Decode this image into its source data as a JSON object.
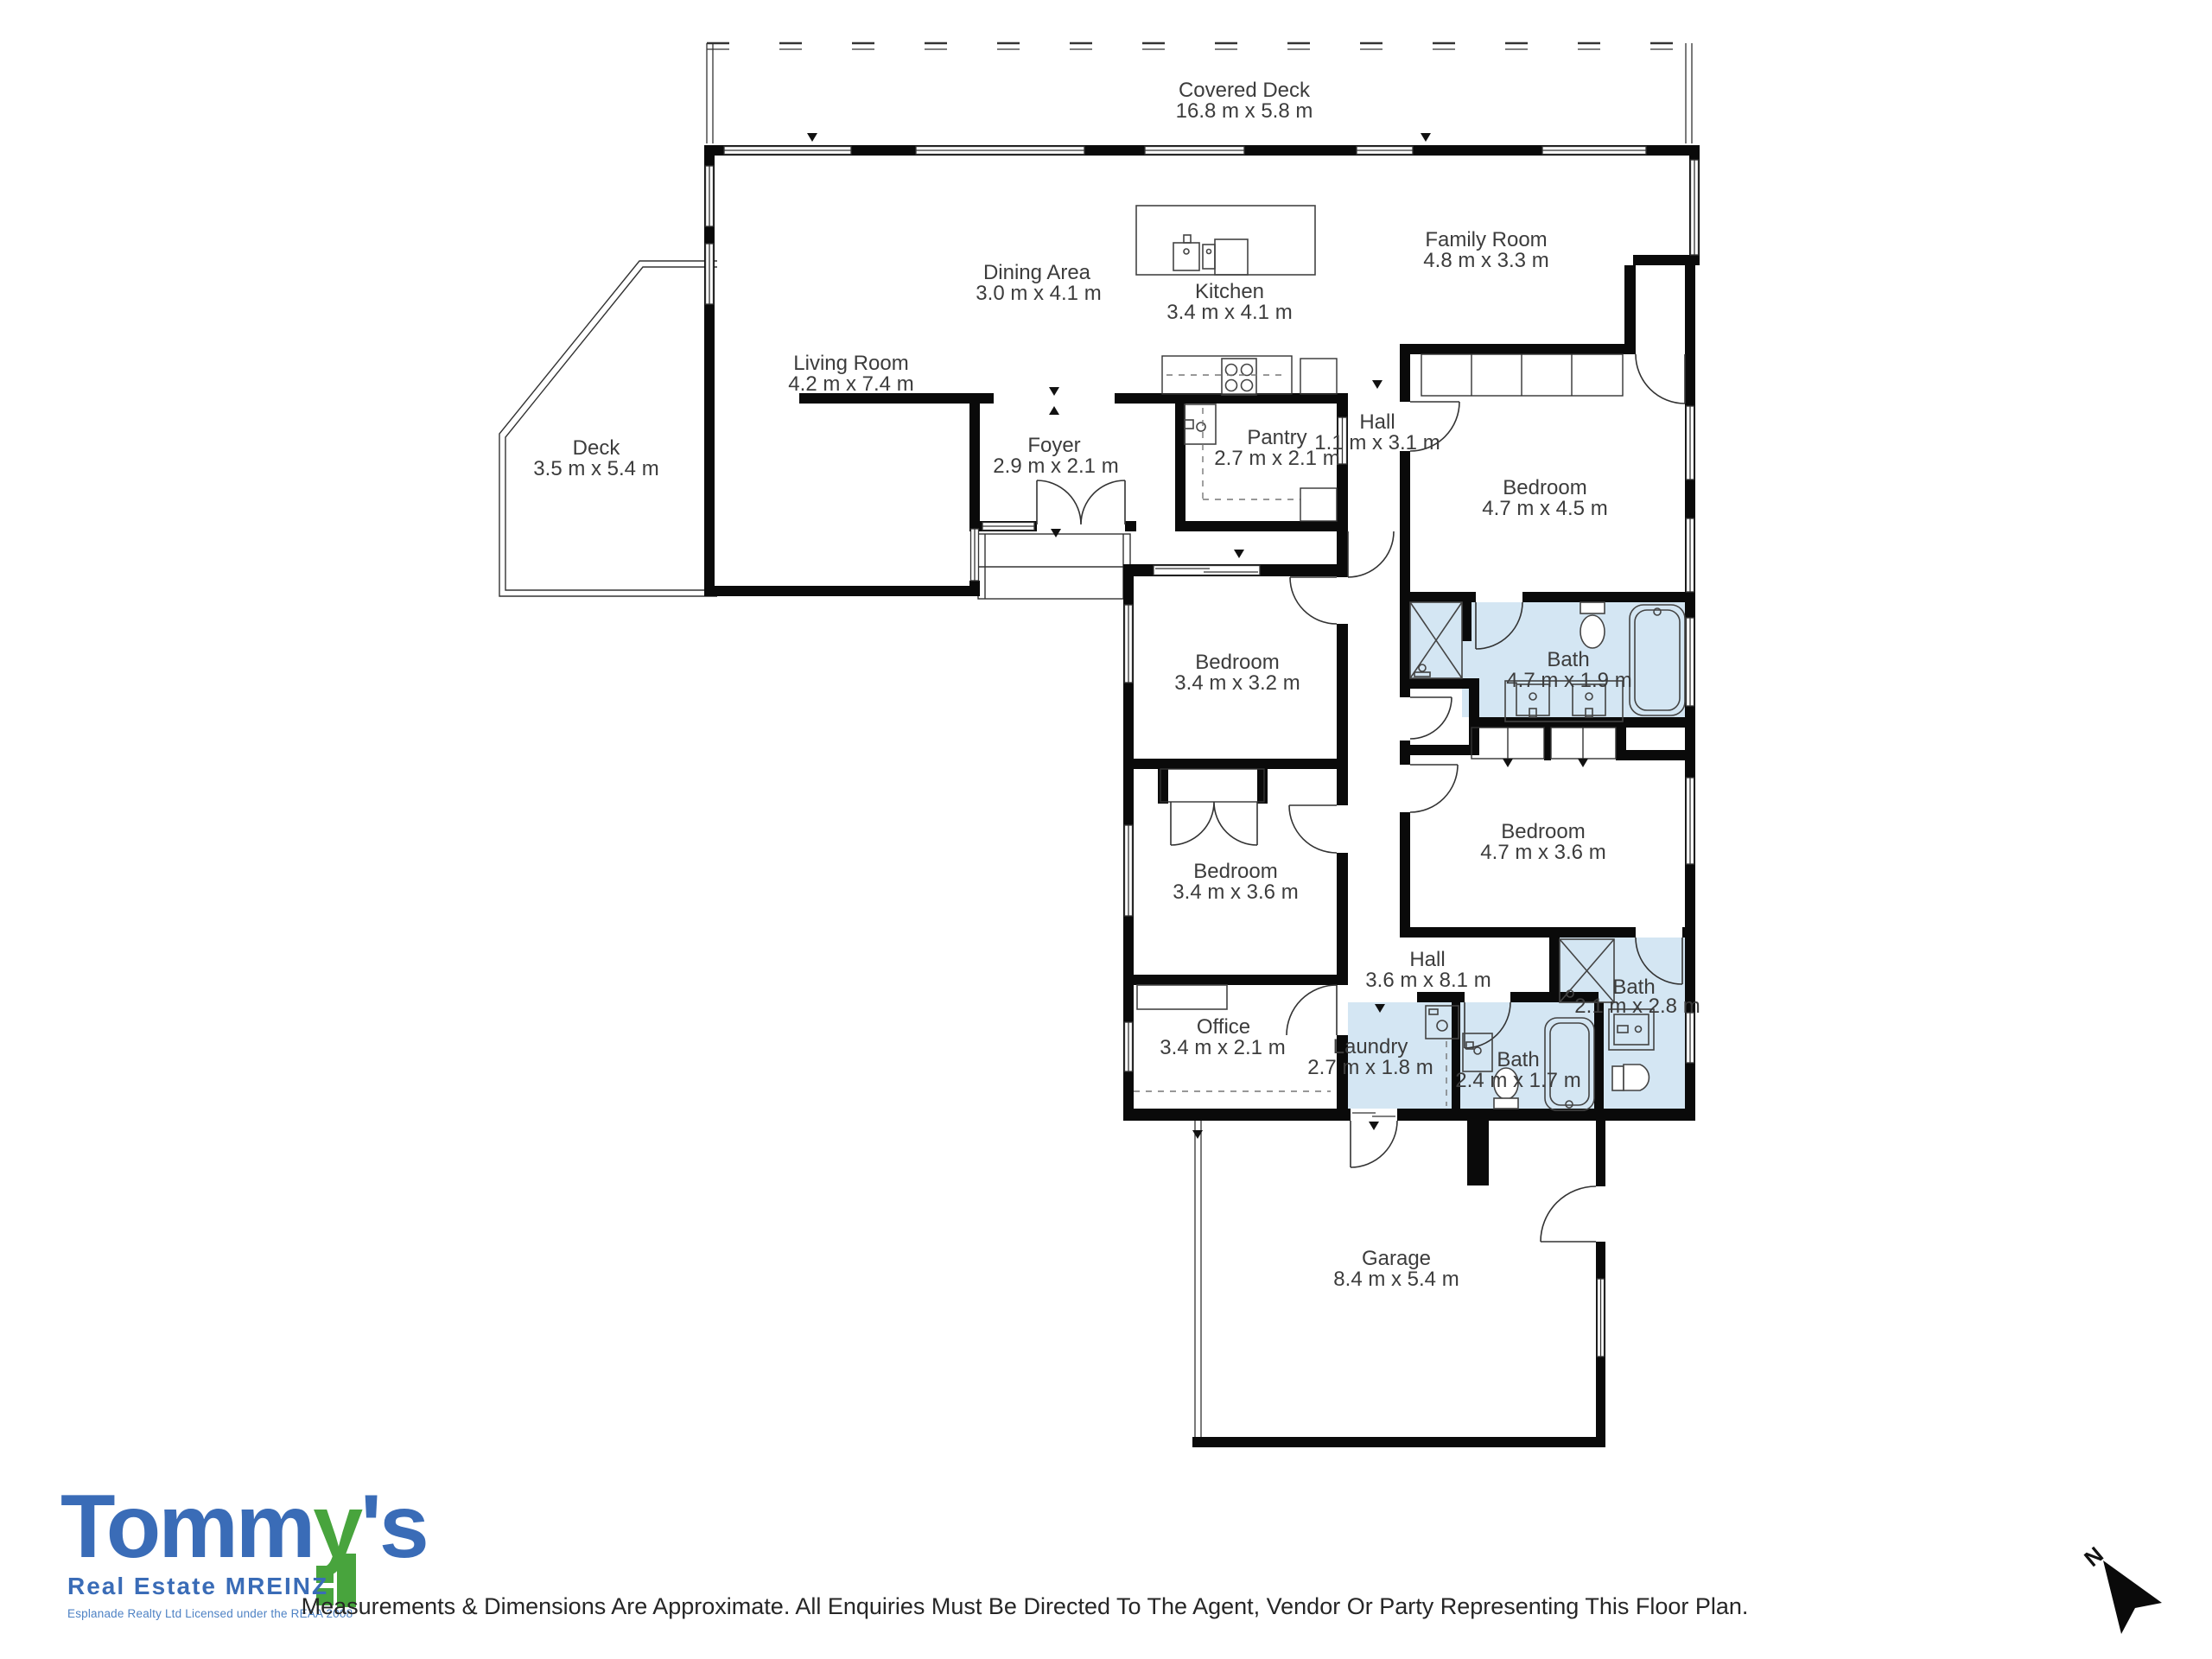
{
  "plan": {
    "rooms": [
      {
        "name": "Covered Deck",
        "dims": "16.8 m x 5.8 m"
      },
      {
        "name": "Family Room",
        "dims": "4.8 m x 3.3 m"
      },
      {
        "name": "Dining Area",
        "dims": "3.0 m x 4.1 m"
      },
      {
        "name": "Kitchen",
        "dims": "3.4 m x 4.1 m"
      },
      {
        "name": "Living Room",
        "dims": "4.2 m x 7.4 m"
      },
      {
        "name": "Deck",
        "dims": "3.5 m x 5.4 m"
      },
      {
        "name": "Foyer",
        "dims": "2.9 m x 2.1 m"
      },
      {
        "name": "Pantry",
        "dims": "2.7 m x 2.1 m"
      },
      {
        "name": "Hall",
        "dims": "1.1 m x 3.1 m"
      },
      {
        "name": "Bedroom",
        "dims": "4.7 m x 4.5 m"
      },
      {
        "name": "Bath",
        "dims": "4.7 m x 1.9 m"
      },
      {
        "name": "Bedroom",
        "dims": "3.4 m x 3.2 m"
      },
      {
        "name": "Bedroom",
        "dims": "4.7 m x 3.6 m"
      },
      {
        "name": "Bedroom",
        "dims": "3.4 m x 3.6 m"
      },
      {
        "name": "Hall",
        "dims": "3.6 m x 8.1 m"
      },
      {
        "name": "Bath",
        "dims": "2.1 m x 2.8 m"
      },
      {
        "name": "Office",
        "dims": "3.4 m x 2.1 m"
      },
      {
        "name": "Laundry",
        "dims": "2.7 m x 1.8 m"
      },
      {
        "name": "Bath",
        "dims": "2.4 m x 1.7 m"
      },
      {
        "name": "Garage",
        "dims": "8.4 m x 5.4 m"
      }
    ],
    "compass_label": "N"
  },
  "branding": {
    "logo_part1": "Tomm",
    "logo_part2": "y",
    "logo_part3": "'s",
    "logo_sub": "Real Estate MREINZ",
    "logo_fine": "Esplanade Realty Ltd Licensed under the REAA 2008"
  },
  "footer": {
    "disclaimer": "Measurements & Dimensions Are Approximate. All Enquiries Must Be Directed To The Agent, Vendor Or Party Representing This Floor Plan."
  },
  "colors": {
    "wall": "#0a0a0a",
    "bath_fill": "#d4e6f3",
    "text": "#3c3c3c",
    "logo_blue": "#3a6cb7",
    "logo_green": "#48a43d",
    "logo_fine_blue": "#4e82c4"
  }
}
